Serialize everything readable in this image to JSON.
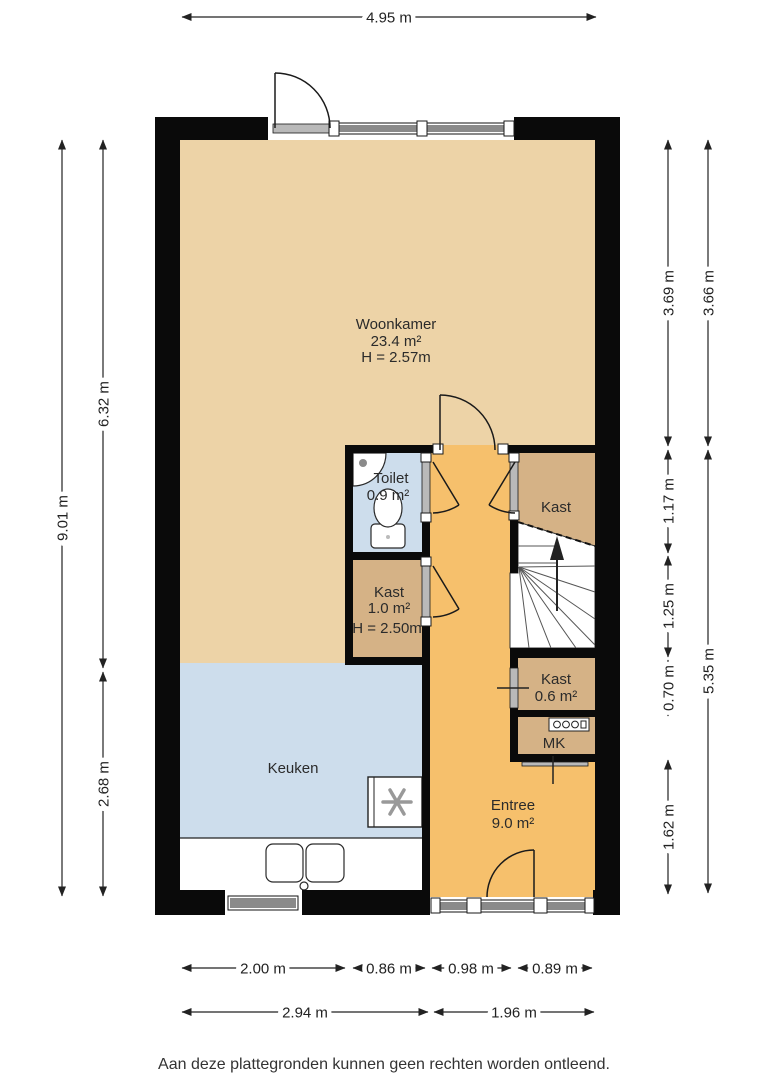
{
  "title": "Floor plan (begane grond)",
  "footer": "Aan deze plattegronden kunnen geen rechten worden ontleend.",
  "colors": {
    "wall": "#0a0a0a",
    "woonkamer": "#edd3a7",
    "keuken": "#cdddec",
    "toilet": "#cdddec",
    "kast": "#d5b286",
    "entree": "#f6c06c",
    "stairs": "#ffffff",
    "dimension_text": "#222222"
  },
  "rooms": {
    "woonkamer": {
      "name": "Woonkamer",
      "area": "23.4 m²",
      "ceiling": "H = 2.57m"
    },
    "toilet": {
      "name": "Toilet",
      "area": "0.9 m²"
    },
    "kast_mid": {
      "name": "Kast",
      "area": "1.0 m²",
      "ceiling": "H = 2.50m"
    },
    "kast_top": {
      "name": "Kast"
    },
    "kast_small": {
      "name": "Kast",
      "area": "0.6 m²"
    },
    "mk": {
      "name": "MK"
    },
    "keuken": {
      "name": "Keuken"
    },
    "entree": {
      "name": "Entree",
      "area": "9.0 m²"
    }
  },
  "dimensions": {
    "top": "4.95 m",
    "left_outer": "9.01 m",
    "left_inner": [
      "6.32 m",
      "2.68 m"
    ],
    "right_inner": [
      "3.69 m",
      "1.17 m",
      "1.25 m",
      "0.70 m",
      "1.62 m"
    ],
    "right_outer": [
      "3.66 m",
      "5.35 m"
    ],
    "bottom_row1": [
      "2.00 m",
      "0.86 m",
      "0.98 m",
      "0.89 m"
    ],
    "bottom_row2": [
      "2.94 m",
      "1.96 m"
    ]
  }
}
